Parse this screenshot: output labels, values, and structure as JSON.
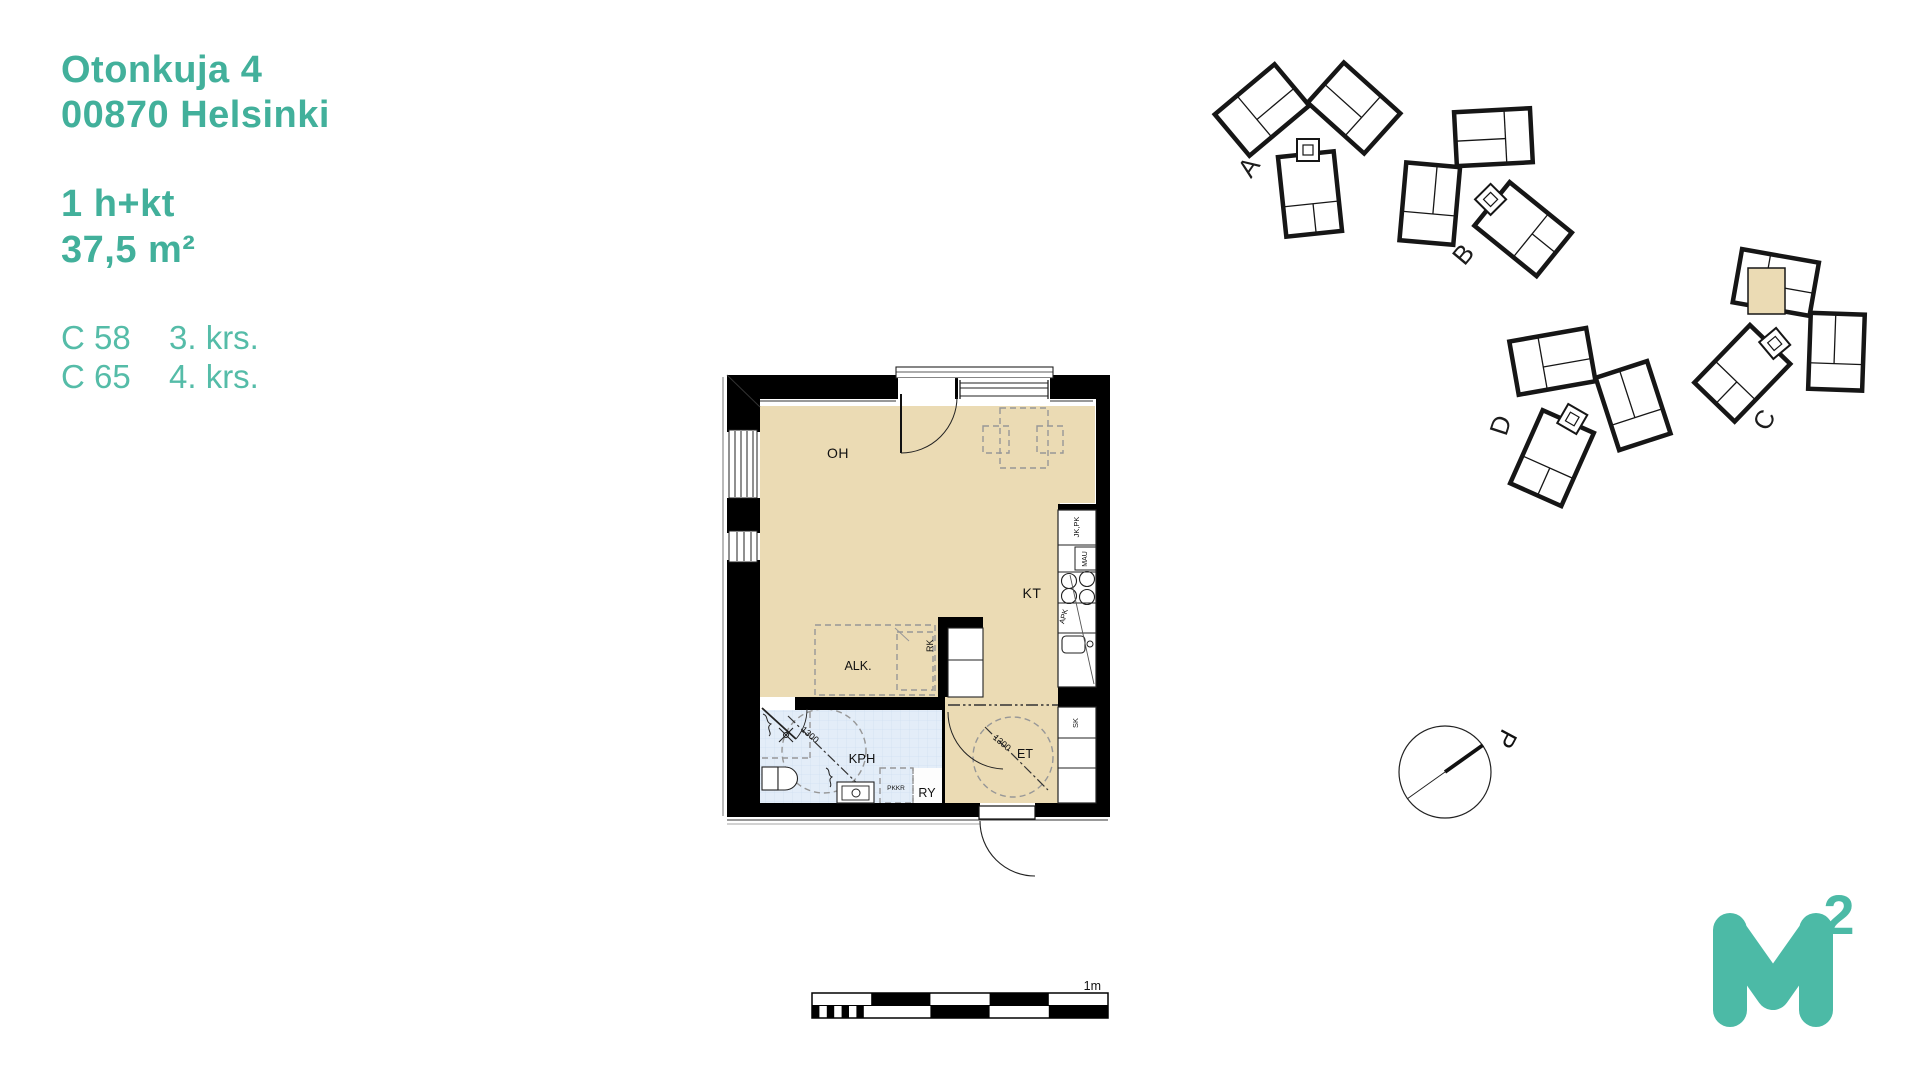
{
  "header": {
    "address_line1": "Otonkuja 4",
    "address_line2": "00870 Helsinki",
    "apartment_type": "1 h+kt",
    "area": "37,5 m²",
    "units": [
      {
        "unit": "C 58",
        "floor": "3. krs."
      },
      {
        "unit": "C 65",
        "floor": "4. krs."
      }
    ]
  },
  "plan": {
    "rooms": {
      "living": "OH",
      "kitchen": "KT",
      "alcove": "ALK.",
      "bathroom": "KPH",
      "hall": "ET",
      "utility": "RY"
    },
    "fixtures": {
      "fridge_freezer": "JK,PK",
      "oven": "MAU",
      "dishwasher": "APK",
      "cleaning_closet": "SK",
      "distribution_cabinet": "RK",
      "laundry_reservation": "PKKR"
    },
    "dimensions": {
      "bathroom_circle": "1300",
      "hall_circle": "1300"
    }
  },
  "scale_bar": {
    "label": "1m"
  },
  "site_plan": {
    "buildings": [
      {
        "label": "A"
      },
      {
        "label": "B"
      },
      {
        "label": "C"
      },
      {
        "label": "D"
      }
    ]
  },
  "compass": {
    "label": "P"
  },
  "logo": {
    "letter": "M",
    "exponent": "2"
  },
  "colors": {
    "teal": "#42b09b",
    "teal_light": "#55bca8",
    "plan_beige": "#ebdbb4",
    "bath_blue": "#e3edf8"
  }
}
